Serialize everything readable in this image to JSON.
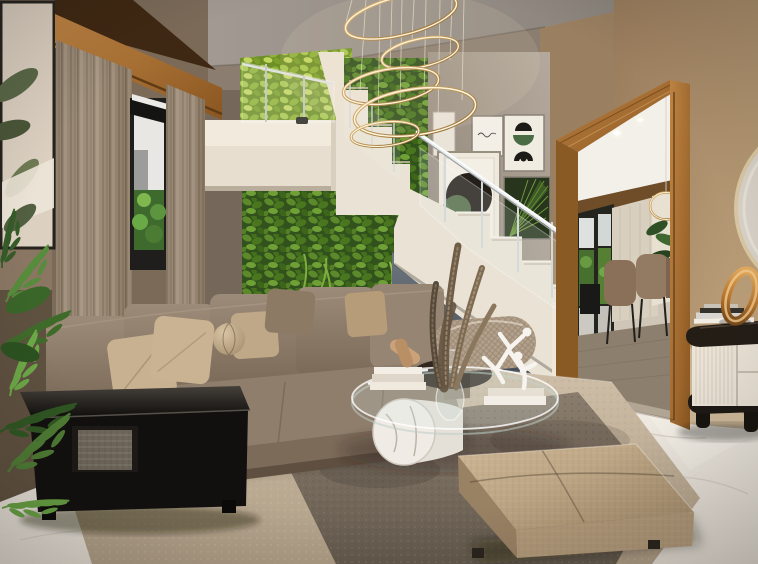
{
  "scene": {
    "type": "interior-architectural-render",
    "room": "double-height living room with staircase and dining room beyond",
    "description": "Photorealistic render of a modern living room: L-shaped taupe sectional sofa with beige throw pillows and a ball pillow, glossy black side table, oval glass coffee table on a lying marble cylinder holding books, a dried pampas arrangement and a white dancing-figures sculpture, beige fabric ottoman on a two-tone rug over white marble flooring. A cream staircase with chrome-and-glass railing climbs past a lush living green wall; a spiral ring LED chandelier hangs from the ceiling. A gallery wall shows five framed botanical prints. A wood-trimmed doorway opens to a dining room with brown chairs, sheer curtains and a gold ring pendant; at right a fluted cream sideboard with a gold ring sculpture, stacked books and a partially visible round mirror. At left, floor-to-ceiling curtains, a tall window and a leafy indoor plant beside a framed leaf artwork."
  },
  "objects": [
    "ring-chandelier",
    "staircase",
    "upper-floor-slab",
    "glass-railing",
    "green-living-wall",
    "gallery-wall",
    "framed-print-signature",
    "framed-print-arcs",
    "framed-print-circles",
    "framed-print-palm",
    "botanical-artwork",
    "curtains",
    "window",
    "wood-pelmet",
    "sectional-sofa",
    "throw-pillows",
    "ball-pillow",
    "bolster-cushion",
    "black-side-table",
    "storage-basket",
    "glass-coffee-table",
    "marble-cylinder-base",
    "pampas-arrangement",
    "figurine-sculpture",
    "stacked-books",
    "wooden-ornament",
    "ottoman",
    "area-rug",
    "marble-floor",
    "doorway",
    "dining-room",
    "dining-table",
    "dining-chairs",
    "pendant-ring-light",
    "ceiling-downlights",
    "sideboard",
    "gold-ring-sculpture",
    "round-mirror",
    "indoor-plant",
    "outdoor-greenery"
  ],
  "palette": {
    "ceiling": "#998f86",
    "wallRight": "#b3966f",
    "wallDoorway": "#9a7f60",
    "wallGallery": "#a89d90",
    "wallLeft": "#8a7663",
    "wallCurtain": "#7b6a58",
    "woodTrim": "#a8712f",
    "curtain": "#9a8a78",
    "greenBright": "#8fae3a",
    "greenDeep": "#44701e",
    "stairCream": "#eae2d4",
    "understair": "#5c656e",
    "sofaTaupe": "#8c7c6a",
    "pillowCream": "#c7b190",
    "blackTable": "#12100e",
    "rugLight": "#c5b49d",
    "rugDark": "#7d7060",
    "marbleFloor": "#efeae2",
    "ottoman": "#c0a987",
    "consoleCream": "#eae3d6",
    "consoleTop": "#241d16",
    "gold": "#c0893f",
    "chrome": "#e6e9ea",
    "diningFloor": "#8d7f6d",
    "chairBrown": "#8a7058",
    "artBase": "#dcd0c1",
    "artLeaf": "#5a6847",
    "plantGreen": "#4e7c34"
  }
}
